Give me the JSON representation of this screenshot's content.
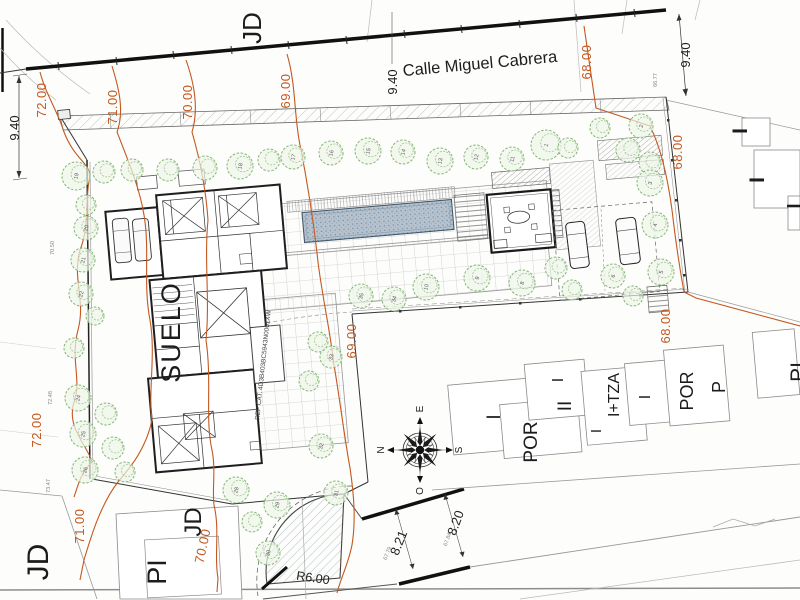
{
  "street": {
    "name": "Calle Miguel Cabrera"
  },
  "zones": {
    "suelo": "SUELO",
    "ref_cat": "REF CAT. 4D3B403BC5943N0001XW",
    "jd": "JD",
    "pi": "PI"
  },
  "neighbors": {
    "por": "POR",
    "p": "P",
    "i": "I",
    "ii": "II",
    "i_tza": "I+TZA"
  },
  "contours": {
    "c68": "68.00",
    "c69": "69.00",
    "c70": "70.00",
    "c71": "71.00",
    "c72": "72.00"
  },
  "dimensions": {
    "street_width": "9.40",
    "road_a": "8.21",
    "road_b": "8.20",
    "radius": "R6.00"
  },
  "compass": {
    "n": "N",
    "e": "E",
    "s": "S",
    "o": "O"
  },
  "colors": {
    "contour": "#c4581f",
    "tree": "#85b575",
    "pool": "#b6c3ce"
  },
  "trees": [
    {
      "n": "19",
      "x": 76,
      "y": 176,
      "r": 14
    },
    {
      "n": "",
      "x": 104,
      "y": 172,
      "r": 11
    },
    {
      "n": "",
      "x": 132,
      "y": 170,
      "r": 11
    },
    {
      "n": "",
      "x": 168,
      "y": 170,
      "r": 11
    },
    {
      "n": "",
      "x": 205,
      "y": 168,
      "r": 12
    },
    {
      "n": "18",
      "x": 240,
      "y": 166,
      "r": 13
    },
    {
      "n": "",
      "x": 269,
      "y": 160,
      "r": 11
    },
    {
      "n": "17",
      "x": 293,
      "y": 157,
      "r": 12
    },
    {
      "n": "16",
      "x": 331,
      "y": 153,
      "r": 12
    },
    {
      "n": "15",
      "x": 368,
      "y": 151,
      "r": 13
    },
    {
      "n": "14",
      "x": 403,
      "y": 152,
      "r": 12
    },
    {
      "n": "13",
      "x": 440,
      "y": 161,
      "r": 13
    },
    {
      "n": "12",
      "x": 476,
      "y": 157,
      "r": 12
    },
    {
      "n": "11",
      "x": 512,
      "y": 159,
      "r": 12
    },
    {
      "n": "1",
      "x": 546,
      "y": 145,
      "r": 15
    },
    {
      "n": "",
      "x": 568,
      "y": 148,
      "r": 10
    },
    {
      "n": "",
      "x": 600,
      "y": 128,
      "r": 10
    },
    {
      "n": "2",
      "x": 641,
      "y": 126,
      "r": 12
    },
    {
      "n": "",
      "x": 628,
      "y": 150,
      "r": 12
    },
    {
      "n": "",
      "x": 650,
      "y": 163,
      "r": 11
    },
    {
      "n": "3",
      "x": 650,
      "y": 183,
      "r": 13
    },
    {
      "n": "4",
      "x": 655,
      "y": 225,
      "r": 13
    },
    {
      "n": "5",
      "x": 661,
      "y": 272,
      "r": 13
    },
    {
      "n": "6",
      "x": 613,
      "y": 276,
      "r": 12
    },
    {
      "n": "",
      "x": 633,
      "y": 296,
      "r": 10
    },
    {
      "n": "35",
      "x": 361,
      "y": 296,
      "r": 12
    },
    {
      "n": "34",
      "x": 394,
      "y": 299,
      "r": 12
    },
    {
      "n": "10",
      "x": 426,
      "y": 287,
      "r": 13
    },
    {
      "n": "9",
      "x": 477,
      "y": 278,
      "r": 13
    },
    {
      "n": "8",
      "x": 522,
      "y": 283,
      "r": 13
    },
    {
      "n": "",
      "x": 556,
      "y": 268,
      "r": 11
    },
    {
      "n": "",
      "x": 572,
      "y": 290,
      "r": 10
    },
    {
      "n": "20",
      "x": 86,
      "y": 228,
      "r": 12
    },
    {
      "n": "21",
      "x": 83,
      "y": 260,
      "r": 12
    },
    {
      "n": "22",
      "x": 81,
      "y": 294,
      "r": 12
    },
    {
      "n": "",
      "x": 86,
      "y": 205,
      "r": 10
    },
    {
      "n": "",
      "x": 95,
      "y": 316,
      "r": 9
    },
    {
      "n": "",
      "x": 74,
      "y": 348,
      "r": 10
    },
    {
      "n": "24",
      "x": 78,
      "y": 398,
      "r": 13
    },
    {
      "n": "25",
      "x": 83,
      "y": 434,
      "r": 13
    },
    {
      "n": "26",
      "x": 85,
      "y": 470,
      "r": 13
    },
    {
      "n": "",
      "x": 106,
      "y": 414,
      "r": 11
    },
    {
      "n": "",
      "x": 113,
      "y": 448,
      "r": 11
    },
    {
      "n": "",
      "x": 125,
      "y": 472,
      "r": 10
    },
    {
      "n": "33",
      "x": 331,
      "y": 357,
      "r": 11
    },
    {
      "n": "",
      "x": 318,
      "y": 342,
      "r": 10
    },
    {
      "n": "",
      "x": 309,
      "y": 381,
      "r": 10
    },
    {
      "n": "32",
      "x": 321,
      "y": 446,
      "r": 12
    },
    {
      "n": "31",
      "x": 336,
      "y": 493,
      "r": 12
    },
    {
      "n": "28",
      "x": 236,
      "y": 490,
      "r": 13
    },
    {
      "n": "29",
      "x": 277,
      "y": 505,
      "r": 13
    },
    {
      "n": "30",
      "x": 268,
      "y": 553,
      "r": 12
    },
    {
      "n": "",
      "x": 252,
      "y": 522,
      "r": 10
    }
  ],
  "spot_elevations": [
    {
      "v": "70.50",
      "x": 54,
      "y": 248,
      "rot": -90
    },
    {
      "v": "72.48",
      "x": 52,
      "y": 398,
      "rot": -90
    },
    {
      "v": "73.47",
      "x": 50,
      "y": 486,
      "rot": -90
    },
    {
      "v": "66.77",
      "x": 657,
      "y": 80,
      "rot": -90
    },
    {
      "v": "67.79",
      "x": 389,
      "y": 554,
      "rot": -68
    },
    {
      "v": "67.84",
      "x": 449,
      "y": 540,
      "rot": -70
    }
  ]
}
